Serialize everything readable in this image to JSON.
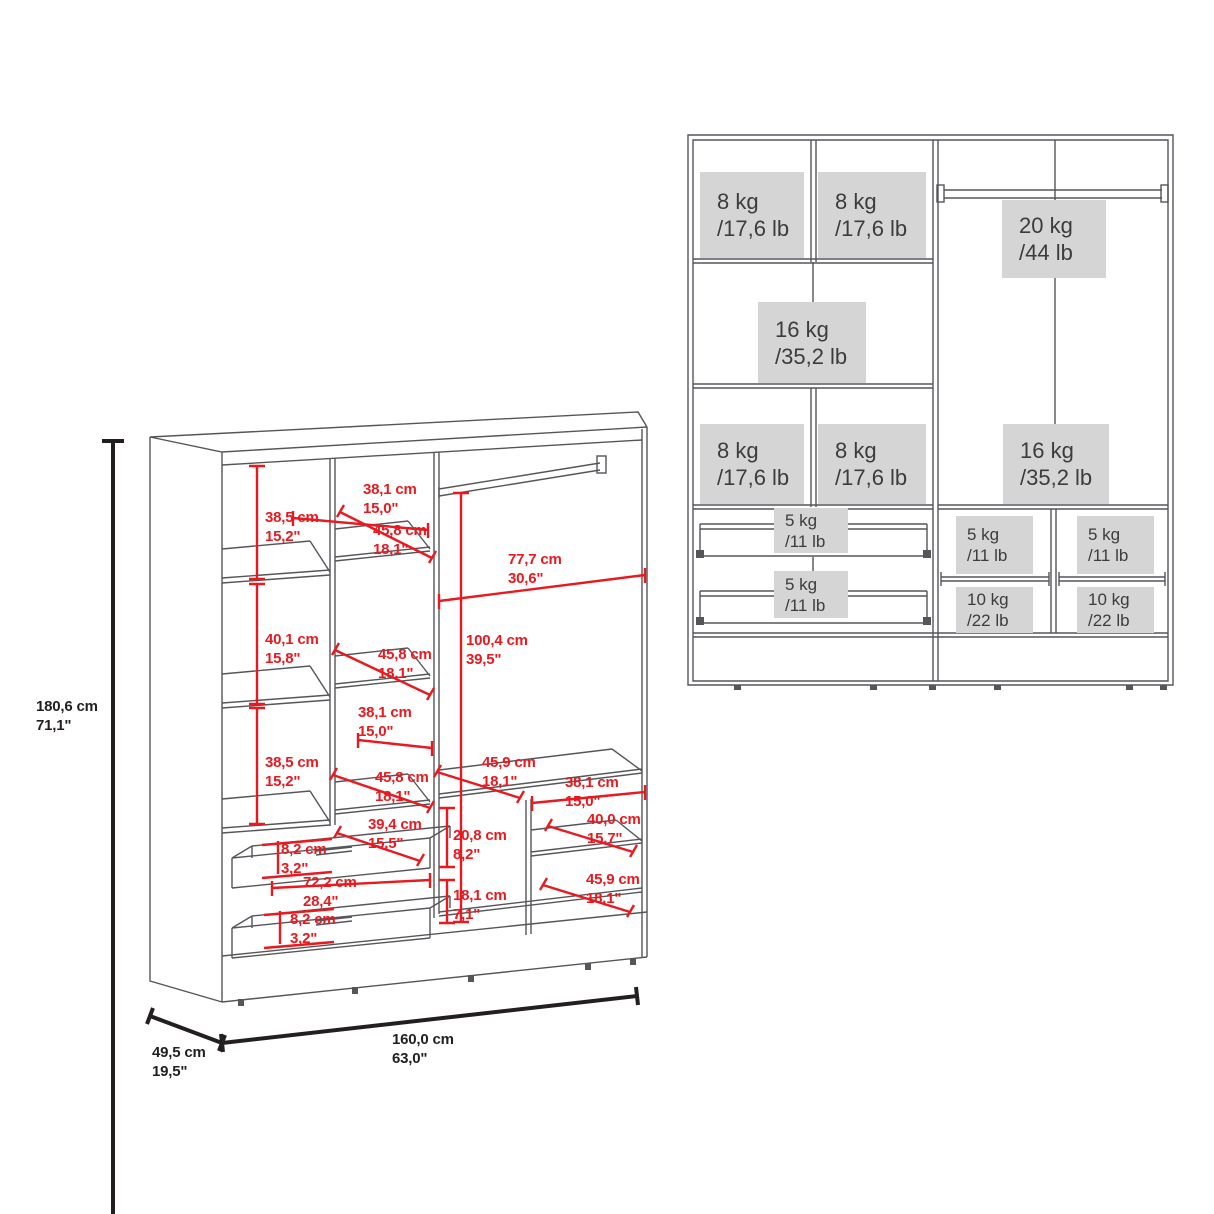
{
  "title": "wardrobe-dimension-and-capacity-diagram",
  "colors": {
    "line_gray": "#55565A",
    "dimension_red": "#E8191F",
    "dimension_black": "#231F20",
    "capacity_box_bg": "#D5D5D5",
    "capacity_text": "#3C3C3E"
  },
  "left_diagram": {
    "name": "wardrobe-3d-dimensions",
    "overall_height": {
      "cm": "180,6 cm",
      "in": "71,1\""
    },
    "overall_depth": {
      "cm": "49,5 cm",
      "in": "19,5\""
    },
    "overall_width": {
      "cm": "160,0 cm",
      "in": "63,0\""
    },
    "dimensions": [
      {
        "id": "top-left-cell-height",
        "cm": "38,5 cm",
        "in": "15,2\""
      },
      {
        "id": "top-middle-cell-width",
        "cm": "38,1 cm",
        "in": "15,0\""
      },
      {
        "id": "top-shelf-depth",
        "cm": "45,8 cm",
        "in": "18,1\""
      },
      {
        "id": "hanging-area-width",
        "cm": "77,7 cm",
        "in": "30,6\""
      },
      {
        "id": "middle-left-cell-height",
        "cm": "40,1 cm",
        "in": "15,8\""
      },
      {
        "id": "middle-shelf-depth",
        "cm": "45,8 cm",
        "in": "18,1\""
      },
      {
        "id": "hanging-area-height",
        "cm": "100,4 cm",
        "in": "39,5\""
      },
      {
        "id": "middle-cell-width",
        "cm": "38,1 cm",
        "in": "15,0\""
      },
      {
        "id": "lower-left-cell-height",
        "cm": "38,5 cm",
        "in": "15,2\""
      },
      {
        "id": "lower-shelf-depth",
        "cm": "45,8 cm",
        "in": "18,1\""
      },
      {
        "id": "right-shelf-depth",
        "cm": "45,9 cm",
        "in": "18,1\""
      },
      {
        "id": "right-cell-width",
        "cm": "38,1 cm",
        "in": "15,0\""
      },
      {
        "id": "drawer-depth",
        "cm": "39,4 cm",
        "in": "15,5\""
      },
      {
        "id": "right-upper-cubby-height",
        "cm": "20,8 cm",
        "in": "8,2\""
      },
      {
        "id": "right-shelf-width",
        "cm": "40,0 cm",
        "in": "15,7\""
      },
      {
        "id": "drawer-inner-height",
        "cm": "8,2 cm",
        "in": "3,2\""
      },
      {
        "id": "drawer-width",
        "cm": "72,2 cm",
        "in": "28,4\""
      },
      {
        "id": "right-lower-cubby-height",
        "cm": "18,1 cm",
        "in": "7,1\""
      },
      {
        "id": "bottom-right-shelf-depth",
        "cm": "45,9 cm",
        "in": "18,1\""
      },
      {
        "id": "drawer2-inner-height",
        "cm": "8,2 cm",
        "in": "3,2\""
      }
    ]
  },
  "right_diagram": {
    "name": "wardrobe-weight-capacities",
    "capacities": [
      {
        "id": "top-left-shelf",
        "kg": "8 kg",
        "lb": "/17,6 lb"
      },
      {
        "id": "top-right-shelf",
        "kg": "8 kg",
        "lb": "/17,6 lb"
      },
      {
        "id": "middle-wide-shelf",
        "kg": "16 kg",
        "lb": "/35,2 lb"
      },
      {
        "id": "lower-left-shelf",
        "kg": "8 kg",
        "lb": "/17,6 lb"
      },
      {
        "id": "lower-right-shelf",
        "kg": "8 kg",
        "lb": "/17,6 lb"
      },
      {
        "id": "hanging-rod",
        "kg": "20 kg",
        "lb": "/44 lb"
      },
      {
        "id": "hanging-section",
        "kg": "16 kg",
        "lb": "/35,2 lb"
      },
      {
        "id": "drawer-1",
        "kg": "5 kg",
        "lb": "/11 lb"
      },
      {
        "id": "drawer-2",
        "kg": "5 kg",
        "lb": "/11 lb"
      },
      {
        "id": "right-shelf-left-column",
        "kg": "5 kg",
        "lb": "/11 lb"
      },
      {
        "id": "right-shelf-right-column",
        "kg": "5 kg",
        "lb": "/11 lb"
      },
      {
        "id": "right-bottom-left-column",
        "kg": "10 kg",
        "lb": "/22 lb"
      },
      {
        "id": "right-bottom-right-column",
        "kg": "10 kg",
        "lb": "/22 lb"
      }
    ]
  }
}
